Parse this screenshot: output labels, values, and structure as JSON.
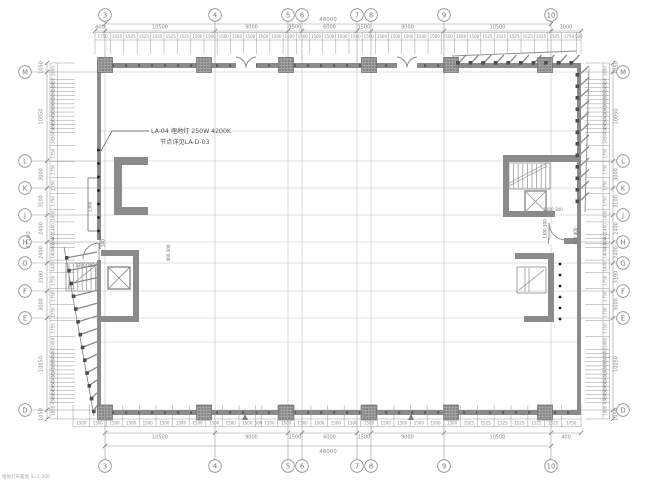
{
  "caption": "埋地灯布置图 S=1:200",
  "annotation": {
    "line1": "LA-04 埋地灯 250W 4200K",
    "line2": "节点详见LA-D-03"
  },
  "grid": {
    "cols": [
      "3",
      "4",
      "5",
      "6",
      "7",
      "8",
      "9",
      "10"
    ],
    "rows": [
      "M",
      "L",
      "K",
      "J",
      "H",
      "G",
      "F",
      "E",
      "D"
    ]
  },
  "dims": {
    "top": {
      "overall": "48000",
      "main": [
        "400",
        "10500",
        "9000",
        "1500",
        "6000",
        "1500",
        "9000",
        "10500",
        "3000"
      ],
      "small": [
        "1750",
        "1525",
        "1525",
        "1525",
        "1525",
        "1525",
        "1525",
        "1500",
        "1500",
        "1500",
        "1500",
        "1500",
        "1500",
        "1500",
        "1500",
        "1500",
        "1500",
        "1500",
        "1500",
        "1500",
        "1500",
        "1500",
        "1500",
        "1500",
        "1500",
        "1500",
        "1500",
        "1500",
        "1500",
        "1525",
        "1525",
        "1525",
        "1525",
        "1525",
        "1525",
        "1750",
        "500"
      ]
    },
    "bottom": {
      "overall": "48000",
      "main": [
        "10500",
        "9000",
        "1500",
        "6000",
        "1500",
        "9000",
        "10500",
        "400"
      ],
      "small": [
        "1500",
        "1500",
        "1500",
        "1500",
        "1500",
        "1500",
        "1500",
        "1500",
        "1500",
        "1500",
        "1500",
        "500",
        "1500",
        "1500",
        "1500",
        "1500",
        "1500",
        "1500",
        "1500",
        "1500",
        "1500",
        "1500",
        "1500",
        "1500",
        "1525",
        "1525",
        "1525",
        "1525",
        "1525",
        "1525",
        "1750"
      ]
    },
    "left": {
      "overall": "37100",
      "main": [
        "1050",
        "10050",
        "3000",
        "3100",
        "2400",
        "2400",
        "3100",
        "3000",
        "10050",
        "1050"
      ],
      "small": [
        "1800",
        "450",
        "450",
        "450",
        "450",
        "450",
        "450",
        "450",
        "450",
        "450",
        "450",
        "450",
        "450",
        "450",
        "1450",
        "1750",
        "1750",
        "1750",
        "1750",
        "1400",
        "1400",
        "400",
        "600",
        "400",
        "1400",
        "1400",
        "1750",
        "1750",
        "1750",
        "1750",
        "1450",
        "450",
        "450",
        "450",
        "450",
        "450",
        "450",
        "450",
        "450",
        "450",
        "450",
        "450",
        "450",
        "450",
        "1800"
      ]
    },
    "right": {
      "main": [
        "1050",
        "10050",
        "3000",
        "3100",
        "2400",
        "2400",
        "3100",
        "3000",
        "10050",
        "1050"
      ],
      "small": [
        "1800",
        "450",
        "450",
        "450",
        "450",
        "450",
        "450",
        "450",
        "450",
        "450",
        "450",
        "450",
        "450",
        "450",
        "1450",
        "1750",
        "1750",
        "1750",
        "1750",
        "1400",
        "1400",
        "400",
        "600",
        "400",
        "1400",
        "1400",
        "1750",
        "1750",
        "1750",
        "1750",
        "1450",
        "450",
        "450",
        "450",
        "450",
        "450",
        "450",
        "450",
        "450",
        "450",
        "450",
        "450",
        "450",
        "450",
        "1800"
      ]
    }
  },
  "detail_dims": {
    "left_core_h": "1300 300",
    "left_core_v": "400 300",
    "left_dots_v": "1300",
    "left_dots_end": "500",
    "right_core_h": "1300 300",
    "right_core_v1": "1300 100",
    "right_core_v2": "600 400"
  },
  "colors": {
    "wall": "#8b8b8b",
    "grid_line": "#c2c2c2",
    "dim_line": "#9a9a9a",
    "dim_text": "#8a8a8a",
    "dark": "#4d4d4d",
    "annotation_text": "#555555",
    "dot": "#1f1f1f"
  }
}
